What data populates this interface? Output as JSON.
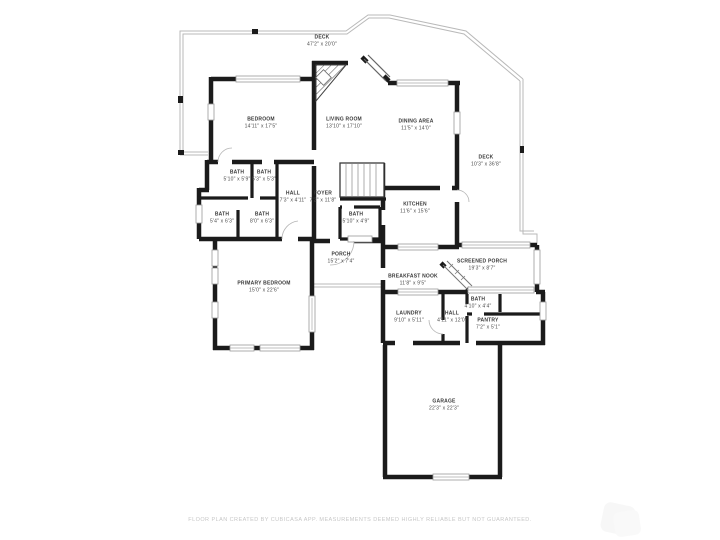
{
  "rooms": [
    {
      "id": "deck-top",
      "name": "DECK",
      "dims": "47'2\" x 20'0\""
    },
    {
      "id": "bedroom",
      "name": "BEDROOM",
      "dims": "14'11\" x 17'5\""
    },
    {
      "id": "living-room",
      "name": "LIVING ROOM",
      "dims": "13'10\" x 17'10\""
    },
    {
      "id": "dining-area",
      "name": "DINING AREA",
      "dims": "11'5\" x 14'0\""
    },
    {
      "id": "deck-right",
      "name": "DECK",
      "dims": "10'3\" x 36'8\""
    },
    {
      "id": "bath-1",
      "name": "BATH",
      "dims": "5'10\" x 5'9\""
    },
    {
      "id": "bath-2",
      "name": "BATH",
      "dims": "5'3\" x 5'3\""
    },
    {
      "id": "hall-upper",
      "name": "HALL",
      "dims": "7'3\" x 4'11\""
    },
    {
      "id": "foyer",
      "name": "FOYER",
      "dims": "7'2\" x 11'8\""
    },
    {
      "id": "bath-3",
      "name": "BATH",
      "dims": "5'4\" x 6'3\""
    },
    {
      "id": "bath-4",
      "name": "BATH",
      "dims": "8'0\" x 6'3\""
    },
    {
      "id": "bath-5",
      "name": "BATH",
      "dims": "5'10\" x 4'9\""
    },
    {
      "id": "kitchen",
      "name": "KITCHEN",
      "dims": "11'6\" x 15'6\""
    },
    {
      "id": "porch",
      "name": "PORCH",
      "dims": "15'2\" x 7'4\""
    },
    {
      "id": "screened-porch",
      "name": "SCREENED PORCH",
      "dims": "19'3\" x 8'7\""
    },
    {
      "id": "breakfast-nook",
      "name": "BREAKFAST NOOK",
      "dims": "11'8\" x 9'5\""
    },
    {
      "id": "primary-bedroom",
      "name": "PRIMARY BEDROOM",
      "dims": "15'0\" x 22'6\""
    },
    {
      "id": "bath-6",
      "name": "BATH",
      "dims": "4'10\" x 4'4\""
    },
    {
      "id": "laundry",
      "name": "LAUNDRY",
      "dims": "9'10\" x 5'11\""
    },
    {
      "id": "hall-lower",
      "name": "HALL",
      "dims": "4'11\" x 12'0\""
    },
    {
      "id": "pantry",
      "name": "PANTRY",
      "dims": "7'2\" x 5'1\""
    },
    {
      "id": "garage",
      "name": "GARAGE",
      "dims": "22'3\" x 22'3\""
    }
  ],
  "footer": {
    "text": "FLOOR PLAN CREATED BY CUBICASA APP. MEASUREMENTS DEEMED HIGHLY RELIABLE BUT NOT GUARANTEED."
  },
  "colors": {
    "wall": "#1b1b1b",
    "deck_outline": "#b9b9b9",
    "label_text": "#3b3b3b",
    "footer_text": "#c7c7c7"
  }
}
